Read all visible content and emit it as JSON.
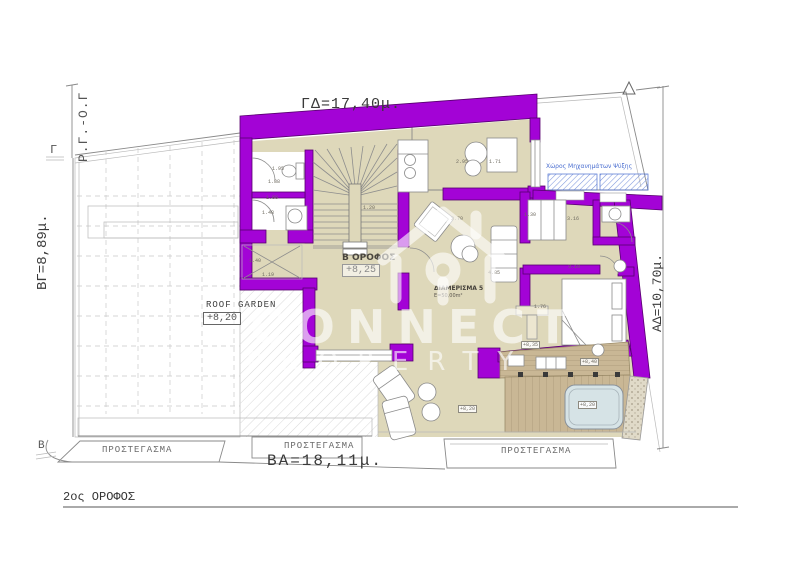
{
  "floor_title": "2ος ΟΡΟΦΟΣ",
  "dimensions": {
    "top": "ΓΔ=17,40μ.",
    "left": "ΒΓ=8,89μ.",
    "bottom": "ΒΑ=18,11μ.",
    "right": "ΑΔ=10,70μ.",
    "left_boundary": "Ρ.Γ.-Ο.Γ"
  },
  "markers": {
    "left": "Γ",
    "bottom_left": "Β"
  },
  "rooms": {
    "roof_garden": {
      "label": "ROOF GARDEN",
      "level": "+8,20"
    },
    "floor_ref": {
      "label": "Β ΟΡΟΦΟΣ",
      "level": "+8,25"
    },
    "apartment": {
      "label": "ΔΙΑΜΕΡΙΣΜΑ 5",
      "area": "Ε=50,00m²"
    },
    "machinery": {
      "label": "Χώρος Μηχανημάτων Ψύξης"
    }
  },
  "canopies": [
    "ΠΡΟΣΤΕΓΑΣΜΑ",
    "ΠΡΟΣΤΕΓΑΣΜΑ",
    "ΠΡΟΣΤΕΓΑΣΜΑ"
  ],
  "watermark": {
    "line1": "CONNECT",
    "line2": "PROPERTY"
  },
  "dim_labels": [
    {
      "t": "1.95",
      "x": 272,
      "y": 166
    },
    {
      "t": "1.88",
      "x": 268,
      "y": 179
    },
    {
      "t": "1.88",
      "x": 266,
      "y": 195
    },
    {
      "t": "1.48",
      "x": 262,
      "y": 210
    },
    {
      "t": "1.40",
      "x": 249,
      "y": 258
    },
    {
      "t": "1.19",
      "x": 262,
      "y": 272
    },
    {
      "t": "1.20",
      "x": 363,
      "y": 205
    },
    {
      "t": "2.95",
      "x": 456,
      "y": 159
    },
    {
      "t": "1.71",
      "x": 489,
      "y": 159
    },
    {
      "t": "3.70",
      "x": 451,
      "y": 216
    },
    {
      "t": "1.30",
      "x": 524,
      "y": 212
    },
    {
      "t": "3.16",
      "x": 567,
      "y": 216
    },
    {
      "t": "3.19",
      "x": 568,
      "y": 264
    },
    {
      "t": "4.85",
      "x": 488,
      "y": 270
    },
    {
      "t": "1.76",
      "x": 534,
      "y": 304
    },
    {
      "t": "+8,35",
      "x": 521,
      "y": 341,
      "boxed": true
    },
    {
      "t": "+8,40",
      "x": 580,
      "y": 358,
      "boxed": true
    },
    {
      "t": "+8,20",
      "x": 458,
      "y": 405,
      "boxed": true
    },
    {
      "t": "+8,20",
      "x": 578,
      "y": 401,
      "boxed": true
    }
  ],
  "colors": {
    "wall": "#a303d6",
    "wall_dark": "#57006e",
    "floor": "#ded8ba",
    "deck": "#c9b795",
    "pool": "#d6e3e6",
    "hatch_blue": "#7d97dd",
    "text_blue": "#4a6ed0"
  }
}
